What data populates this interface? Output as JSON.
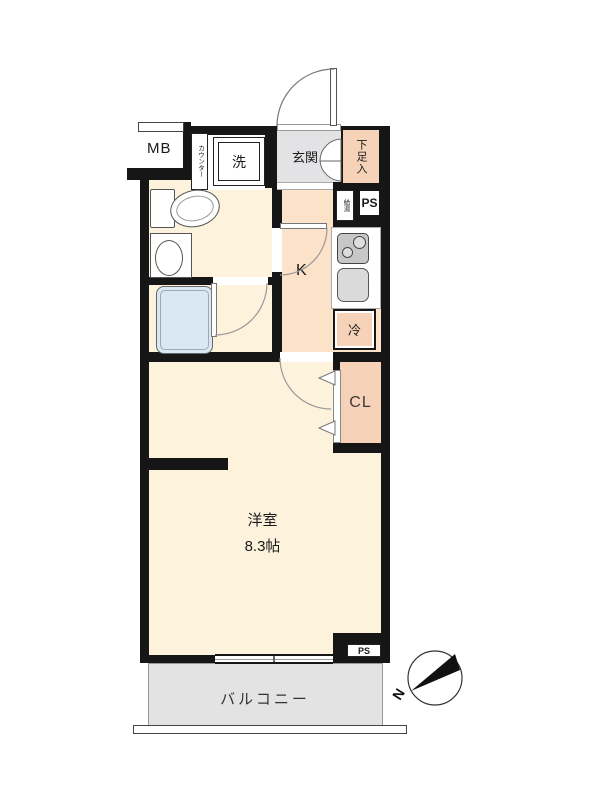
{
  "floorplan": {
    "title": "japanese-apartment-floor-plan",
    "labels": {
      "meter_box": "MB",
      "counter": "カウンター",
      "washing_machine": "洗",
      "entrance": "玄関",
      "shoe_cabinet": "下足入",
      "water_heater": "給湯",
      "pipe_space_top": "PS",
      "kitchen": "K",
      "refrigerator": "冷",
      "closet": "CL",
      "main_room_name": "洋室",
      "main_room_size": "8.3帖",
      "pipe_space_bottom": "PS",
      "balcony": "バルコニー",
      "compass_north": "N"
    },
    "colors": {
      "wall": "#161616",
      "room-cream": "#fdf3dc",
      "hall-peach": "#fbe2c8",
      "storage-peach": "#f6d2b8",
      "entrance-gray": "#e3e3e5",
      "balcony-gray": "#e3e3e3",
      "bathtub-blue": "#d9e8f3",
      "equipment-gray": "#c7c7c7"
    }
  }
}
